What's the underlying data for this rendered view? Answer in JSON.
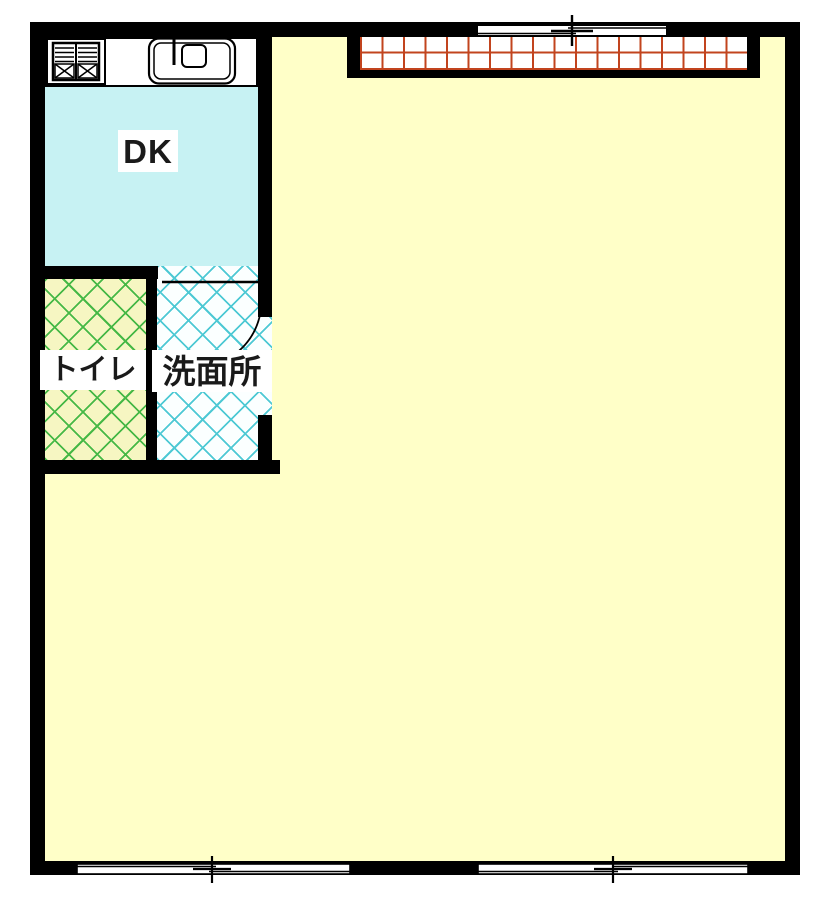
{
  "floorplan": {
    "rooms": {
      "dk": {
        "label": "DK"
      },
      "toilet": {
        "label": "トイレ"
      },
      "washroom": {
        "label": "洗面所"
      },
      "living": {
        "label": ""
      }
    },
    "fixtures": {
      "stove": "stove-icon",
      "sink": "sink-icon",
      "lattice_window": "lattice-window-icon",
      "door": "door-swing-icon",
      "sliding_windows": [
        "top",
        "bottom-left",
        "bottom-right"
      ]
    },
    "colors": {
      "wall": "#000000",
      "dk_floor": "#C7F2F3",
      "living_floor": "#FFFFC8",
      "toilet_floor": "#F6F6C2",
      "toilet_hatch": "#46B846",
      "washroom_floor": "#FBFFFF",
      "washroom_hatch": "#4EC9D4",
      "window_grid": "#C2441E",
      "label_text": "#1A1A1A"
    }
  }
}
